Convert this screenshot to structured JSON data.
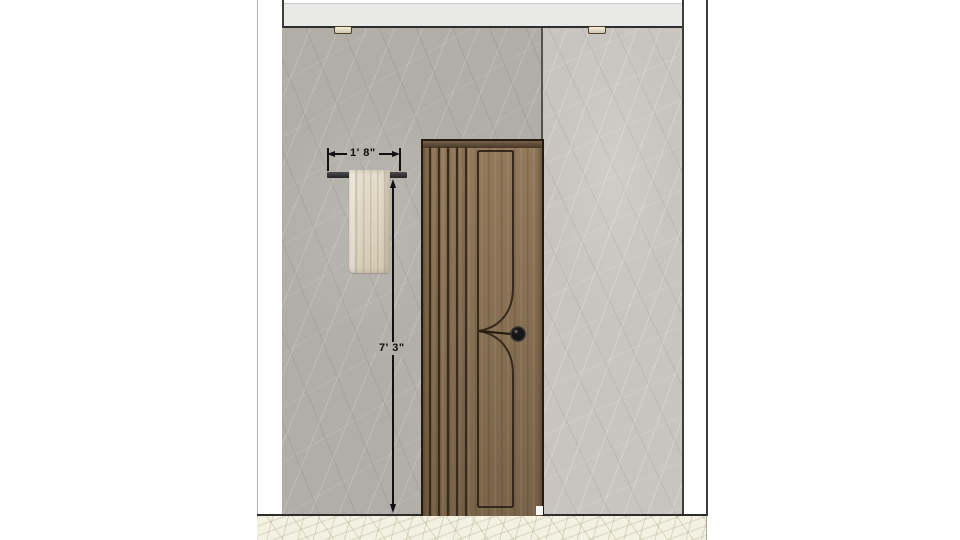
{
  "scene": {
    "type": "interior-elevation-render",
    "description": "Bathroom wall elevation with slatted wood door, towel bar with towel, marble wall panels, two recessed ceiling lights",
    "background": "#ffffff"
  },
  "dimensions": {
    "towel_bar_width": {
      "label": "1' 8\""
    },
    "towel_bar_height_from_floor": {
      "label": "7' 3\""
    }
  },
  "objects": {
    "door": "wood slat door with arc groove detail and round knob",
    "door_slat_groove_count": 5,
    "towel_bar": "wall-mounted black towel bar",
    "towel": "cream hanging towel",
    "ceiling_lights_count": 2,
    "wall_panels": 2
  },
  "colors": {
    "wall_left": "#b1ada7",
    "wall_right": "#c8c5c0",
    "ceiling_band": "#e9e9e7",
    "floor_marble": "#f3f1e2",
    "door_wood": "#8a7153",
    "door_groove": "#32261a",
    "towel": "#dbd2bd",
    "hardware_black": "#1a1a1a",
    "dimension_ink": "#111111"
  }
}
